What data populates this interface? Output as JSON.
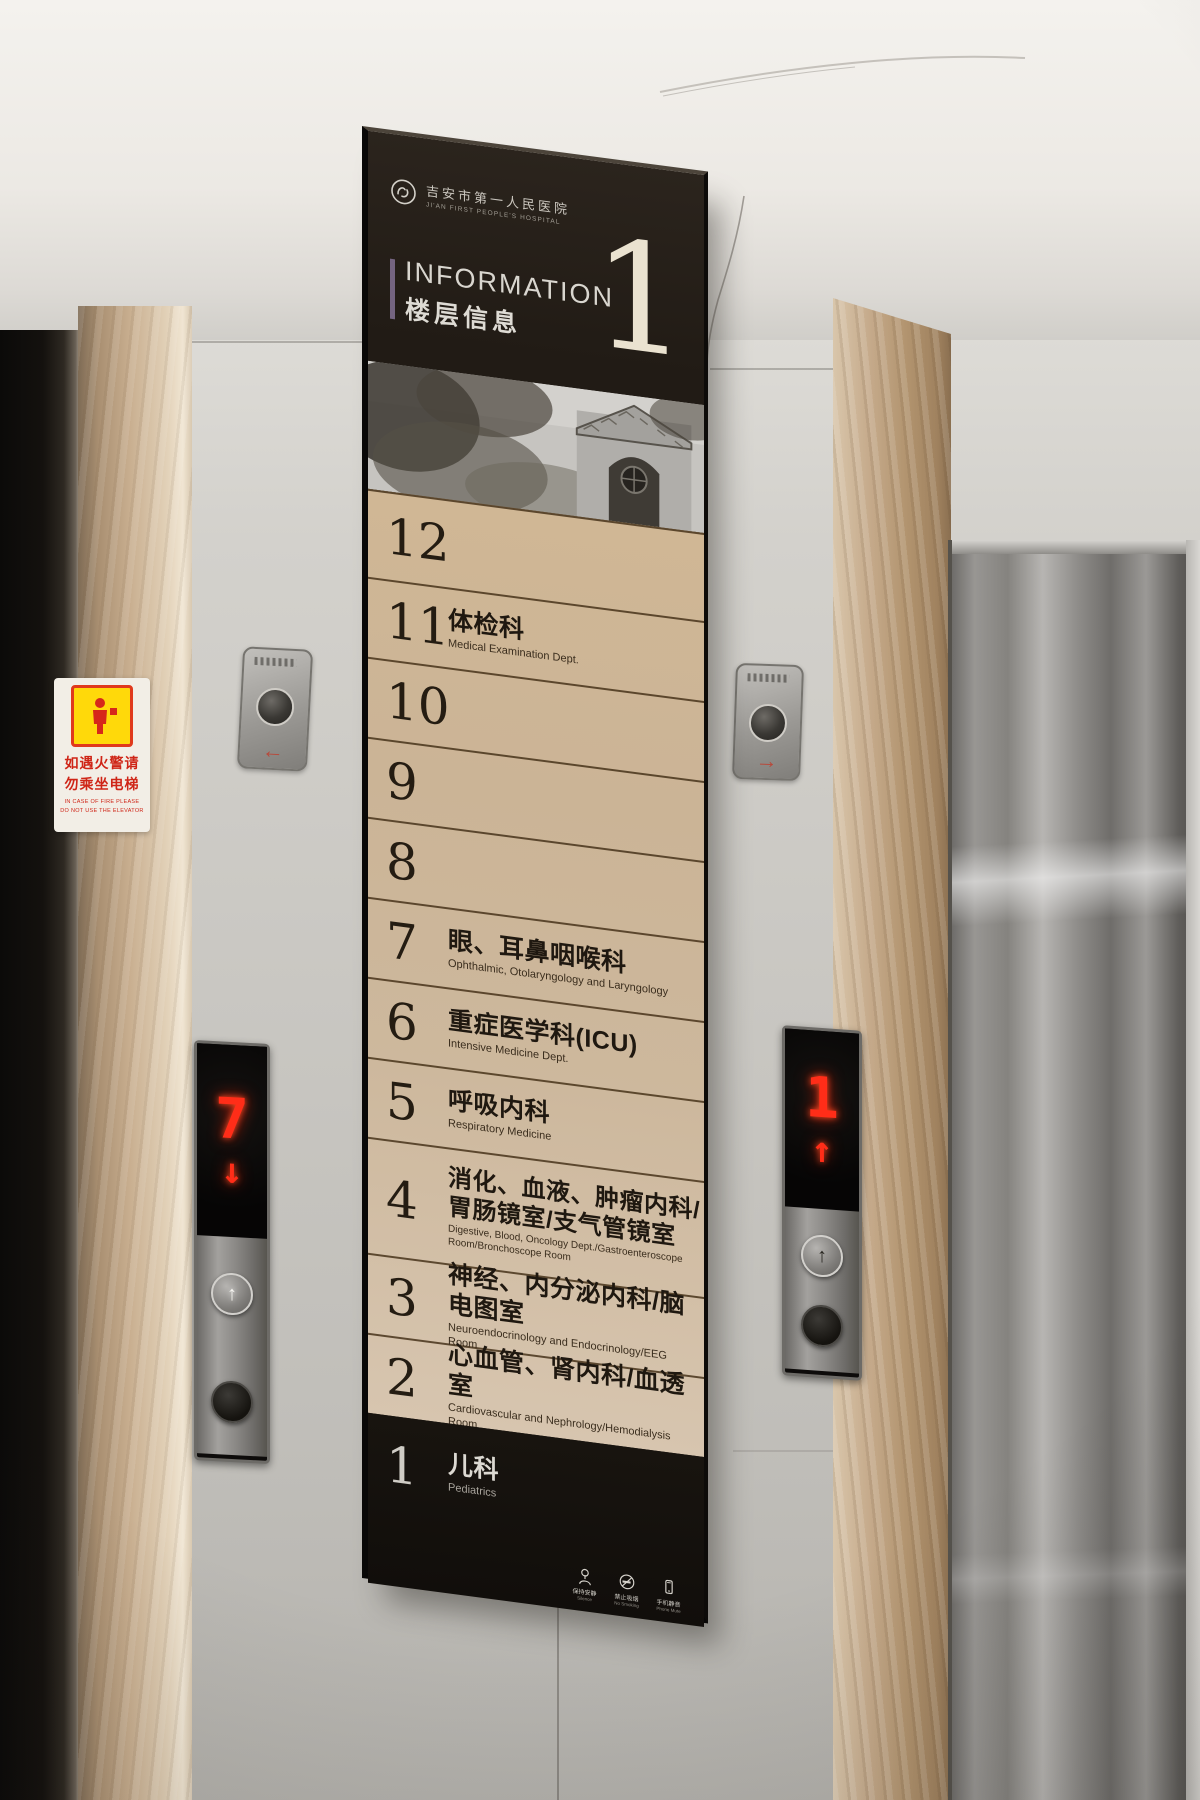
{
  "sign": {
    "hospital_name_zh": "吉安市第一人民医院",
    "hospital_name_en": "JI'AN FIRST PEOPLE'S HOSPITAL",
    "title_en": "INFORMATION",
    "title_zh": "楼层信息",
    "big_number": "1",
    "floors": [
      {
        "number": "12",
        "dept_zh": "",
        "dept_en": ""
      },
      {
        "number": "11",
        "dept_zh": "体检科",
        "dept_en": "Medical Examination Dept."
      },
      {
        "number": "10",
        "dept_zh": "",
        "dept_en": ""
      },
      {
        "number": "9",
        "dept_zh": "",
        "dept_en": ""
      },
      {
        "number": "8",
        "dept_zh": "",
        "dept_en": ""
      },
      {
        "number": "7",
        "dept_zh": "眼、耳鼻咽喉科",
        "dept_en": "Ophthalmic, Otolaryngology and Laryngology"
      },
      {
        "number": "6",
        "dept_zh": "重症医学科(ICU)",
        "dept_en": "Intensive Medicine Dept."
      },
      {
        "number": "5",
        "dept_zh": "呼吸内科",
        "dept_en": "Respiratory Medicine"
      },
      {
        "number": "4",
        "dept_zh": "消化、血液、肿瘤内科/胃肠镜室/支气管镜室",
        "dept_en": "Digestive, Blood, Oncology Dept./Gastroenteroscope Room/Bronchoscope Room"
      },
      {
        "number": "3",
        "dept_zh": "神经、内分泌内科/脑电图室",
        "dept_en": "Neuroendocrinology and Endocrinology/EEG Room"
      },
      {
        "number": "2",
        "dept_zh": "心血管、肾内科/血透室",
        "dept_en": "Cardiovascular and Nephrology/Hemodialysis Room"
      },
      {
        "number": "1",
        "dept_zh": "儿科",
        "dept_en": "Pediatrics"
      }
    ],
    "etiquette": [
      {
        "zh": "保持安静",
        "en": "Silence"
      },
      {
        "zh": "禁止吸烟",
        "en": "No Smoking"
      },
      {
        "zh": "手机静音",
        "en": "Phone Mute"
      }
    ]
  },
  "fire_notice": {
    "zh_line1": "如遇火警请",
    "zh_line2": "勿乘坐电梯",
    "en_line1": "IN CASE OF FIRE PLEASE",
    "en_line2": "DO NOT USE THE ELEVATOR"
  },
  "left_elevator": {
    "floor": "7",
    "arrow": "↓",
    "call_up": "↑"
  },
  "right_elevator": {
    "floor": "1",
    "arrow": "↑",
    "call_up": "↑"
  },
  "colors": {
    "led_red": "#ff2d18",
    "sign_bg": "#1d1812",
    "row_cream": "#cdb89d",
    "accent_bar": "#746480",
    "marble": "#c6ab8c",
    "fire_red": "#cf2517",
    "fire_yellow": "#ffd90a"
  }
}
